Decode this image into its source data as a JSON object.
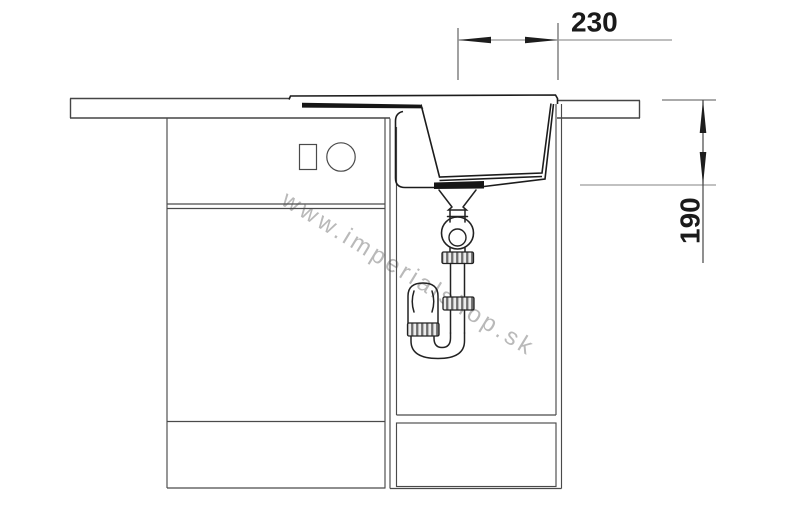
{
  "drawing": {
    "type": "sink-installation-cross-section",
    "dimension_width": {
      "label": "230"
    },
    "dimension_depth": {
      "label": "190"
    },
    "watermark": "www.imperialshop.sk"
  },
  "colors": {
    "line": "#4a4a4a",
    "sink_line": "#1c1c1c",
    "dim_line_light": "#979797",
    "dim_line_dark": "#454545",
    "dim_text": "#1a1a1a",
    "arrow": "#1d1d1d",
    "watermark": "#b6b6b6",
    "background": "#ffffff"
  }
}
